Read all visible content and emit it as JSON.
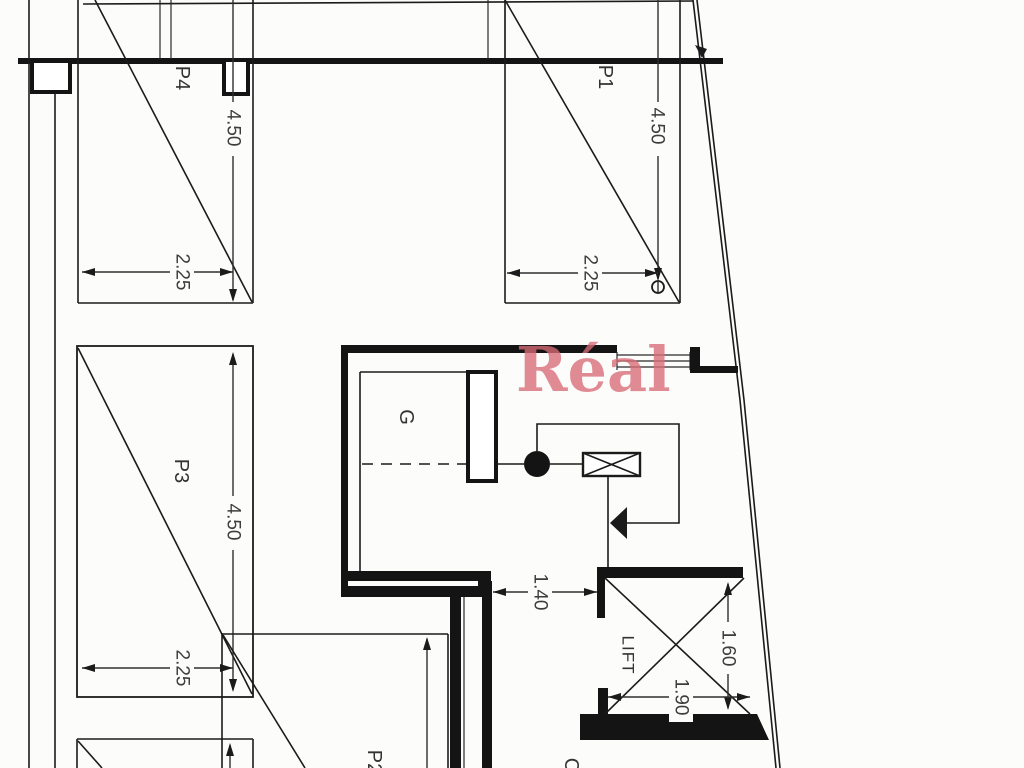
{
  "watermark": {
    "text": "Réal"
  },
  "labels": {
    "p1": "P1",
    "p2": "P2",
    "p3": "P3",
    "p4": "P4",
    "garage": "G",
    "lift": "LIFT",
    "corridor": "C"
  },
  "dimensions": {
    "p4_depth": "4.50",
    "p4_width": "2.25",
    "p1_depth": "4.50",
    "p1_width": "2.25",
    "p3_depth": "4.50",
    "p3_width": "2.25",
    "corridor_width": "1.40",
    "lift_depth": "1.60",
    "lift_width": "1.90"
  },
  "colors": {
    "ink": "#1b1b1b",
    "dim_text": "#3d3d3d",
    "watermark": "#d96b76",
    "background": "#fcfcfb"
  }
}
